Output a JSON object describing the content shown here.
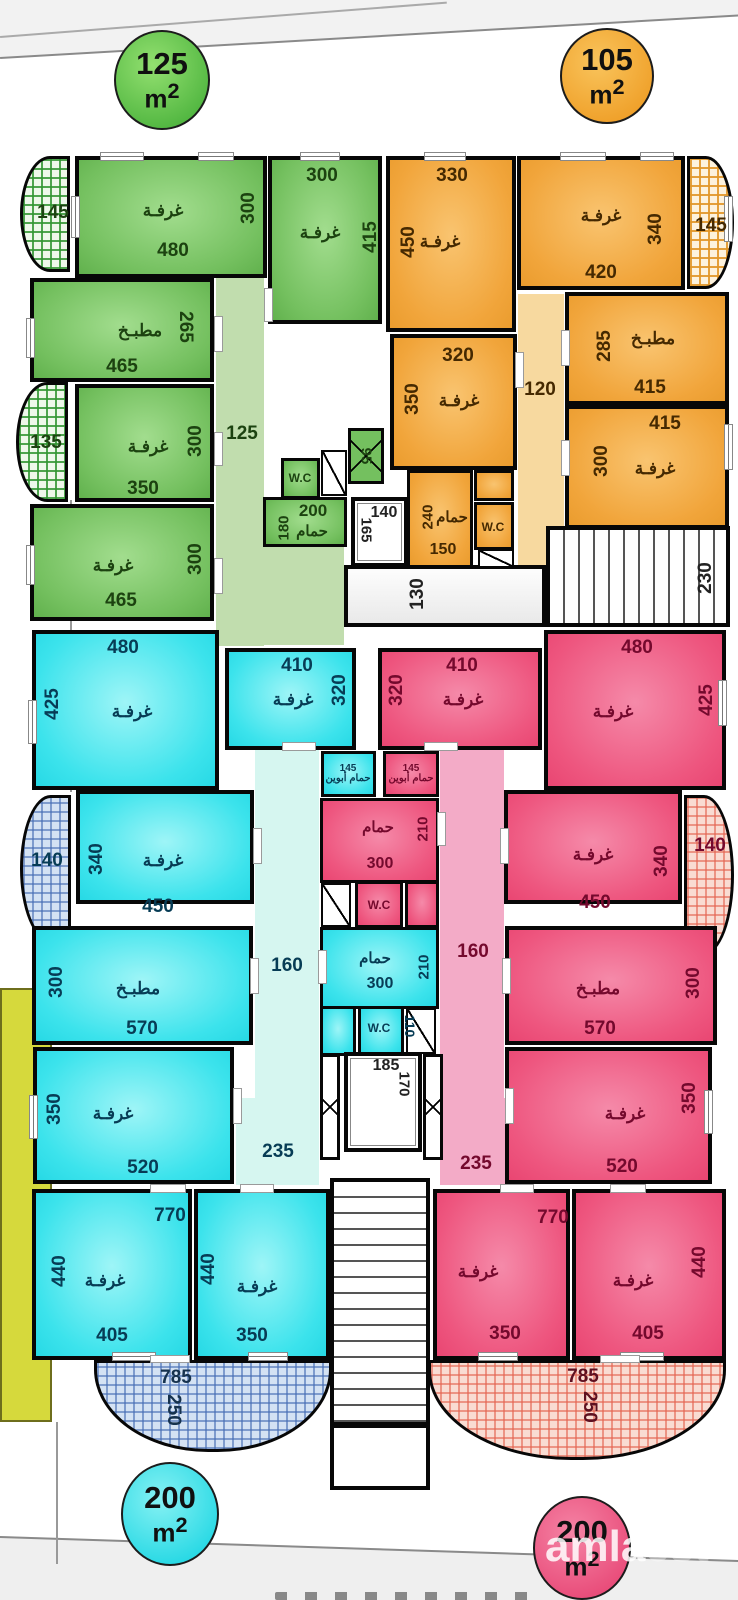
{
  "badges": {
    "tl": {
      "num": "125",
      "unit": "m",
      "sup": "2"
    },
    "tr": {
      "num": "105",
      "unit": "m",
      "sup": "2"
    },
    "bl": {
      "num": "200",
      "unit": "m",
      "sup": "2"
    },
    "br": {
      "num": "200",
      "unit": "m",
      "sup": "2"
    }
  },
  "green": {
    "balcony_top": "145",
    "balcony_mid": "135",
    "hall": "125",
    "duct": "95",
    "wc": "W.C",
    "r1": {
      "name": "غرفـة",
      "w": "480",
      "h": "300"
    },
    "r2": {
      "name": "غرفـة",
      "w": "300",
      "h": "415"
    },
    "kitchen": {
      "name": "مطبـخ",
      "w": "465",
      "h": "265"
    },
    "r3": {
      "name": "غرفـة",
      "w": "350",
      "h": "300"
    },
    "r4": {
      "name": "غرفـة",
      "w": "465",
      "h": "300"
    },
    "bath": {
      "name": "حمام",
      "w": "200",
      "h": "180"
    }
  },
  "orange": {
    "balcony_top": "145",
    "hall": "120",
    "wc": "W.C",
    "r1": {
      "name": "غرفـة",
      "w": "330",
      "h": "450"
    },
    "r2": {
      "name": "غرفـة",
      "w": "420",
      "h": "340"
    },
    "r3": {
      "name": "غرفـة",
      "w": "320",
      "h": "350"
    },
    "kitchen": {
      "name": "مطبـخ",
      "w": "415",
      "h": "285"
    },
    "r4": {
      "name": "غرفـة",
      "w": "415",
      "h": "300"
    },
    "bath": {
      "name": "حمام",
      "w": "150",
      "h": "240"
    }
  },
  "core": {
    "lift_top": {
      "w": "140",
      "d": "165"
    },
    "hall_top": "130",
    "stairs_top": "230",
    "lift_bottom": {
      "w": "185",
      "d": "170"
    }
  },
  "cyan": {
    "balcony_mid": "140",
    "hall": "160",
    "lobby": "235",
    "span": "770",
    "wc": "W.C",
    "wc_d": "110",
    "r1": {
      "name": "غرفـة",
      "w": "480",
      "h": "425"
    },
    "r2": {
      "name": "غرفـة",
      "w": "410",
      "h": "320"
    },
    "parents_bath": {
      "n": "145",
      "l1": "حمام",
      "l2": "أبوين"
    },
    "r3": {
      "name": "غرفـة",
      "w": "450",
      "h": "340"
    },
    "kitchen": {
      "name": "مطبـخ",
      "w": "570",
      "h": "300"
    },
    "r4": {
      "name": "غرفـة",
      "w": "520",
      "h": "350"
    },
    "bath": {
      "name": "حمام",
      "w": "300",
      "h": "210"
    },
    "r5": {
      "name": "غرفـة",
      "w": "405",
      "h": "440"
    },
    "r6": {
      "name": "غرفـة",
      "w": "350",
      "h": "440"
    },
    "balcony_bottom": {
      "w": "785",
      "d": "250"
    }
  },
  "pink": {
    "balcony_mid": "140",
    "hall": "160",
    "lobby": "235",
    "span": "770",
    "wc": "W.C",
    "r1": {
      "name": "غرفـة",
      "w": "410",
      "h": "320"
    },
    "r2": {
      "name": "غرفـة",
      "w": "480",
      "h": "425"
    },
    "parents_bath": {
      "n": "145",
      "l1": "حمام",
      "l2": "أبوين"
    },
    "r3": {
      "name": "غرفـة",
      "w": "450",
      "h": "340"
    },
    "kitchen": {
      "name": "مطبـخ",
      "w": "570",
      "h": "300"
    },
    "r4": {
      "name": "غرفـة",
      "w": "520",
      "h": "350"
    },
    "bath": {
      "name": "حمام",
      "w": "300",
      "h": "210"
    },
    "r5": {
      "name": "غرفـة",
      "w": "350",
      "h": "440"
    },
    "r6": {
      "name": "غرفـة",
      "w": "405",
      "h": "440"
    },
    "balcony_bottom": {
      "w": "785",
      "d": "250"
    }
  },
  "watermark": {
    "strong": "amla",
    "faint": "est"
  }
}
